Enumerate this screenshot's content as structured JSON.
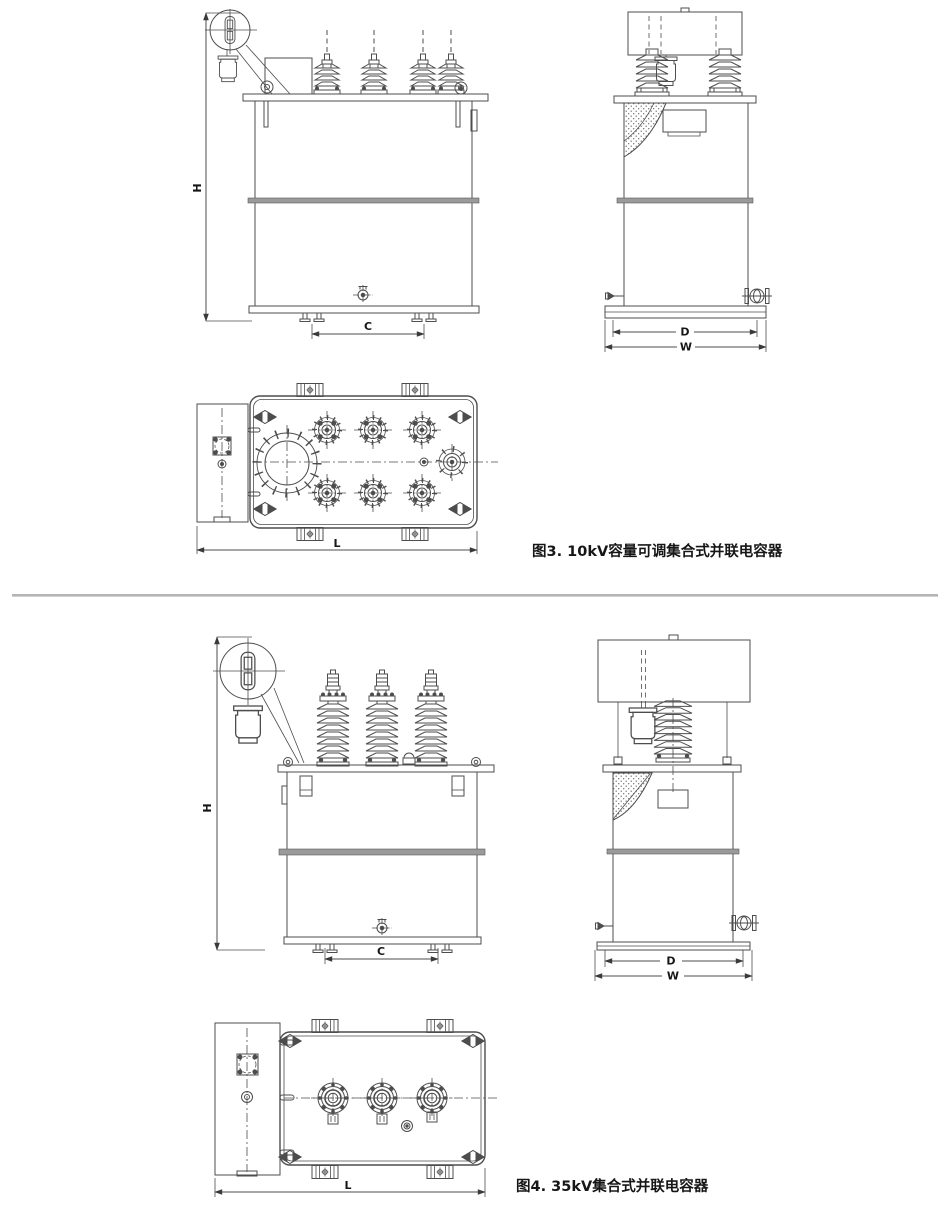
{
  "page": {
    "background": "#ffffff",
    "line_color": "#4d4d4d",
    "separator_color": "#b5b5b5",
    "text_color": "#161616"
  },
  "fig3": {
    "caption": "图3.  10kV容量可调集合式并联电容器",
    "dims": {
      "H": "H",
      "C": "C",
      "D": "D",
      "W": "W",
      "L": "L"
    }
  },
  "fig4": {
    "caption": "图4.  35kV集合式并联电容器",
    "dims": {
      "H": "H",
      "C": "C",
      "D": "D",
      "W": "W",
      "L": "L"
    }
  }
}
